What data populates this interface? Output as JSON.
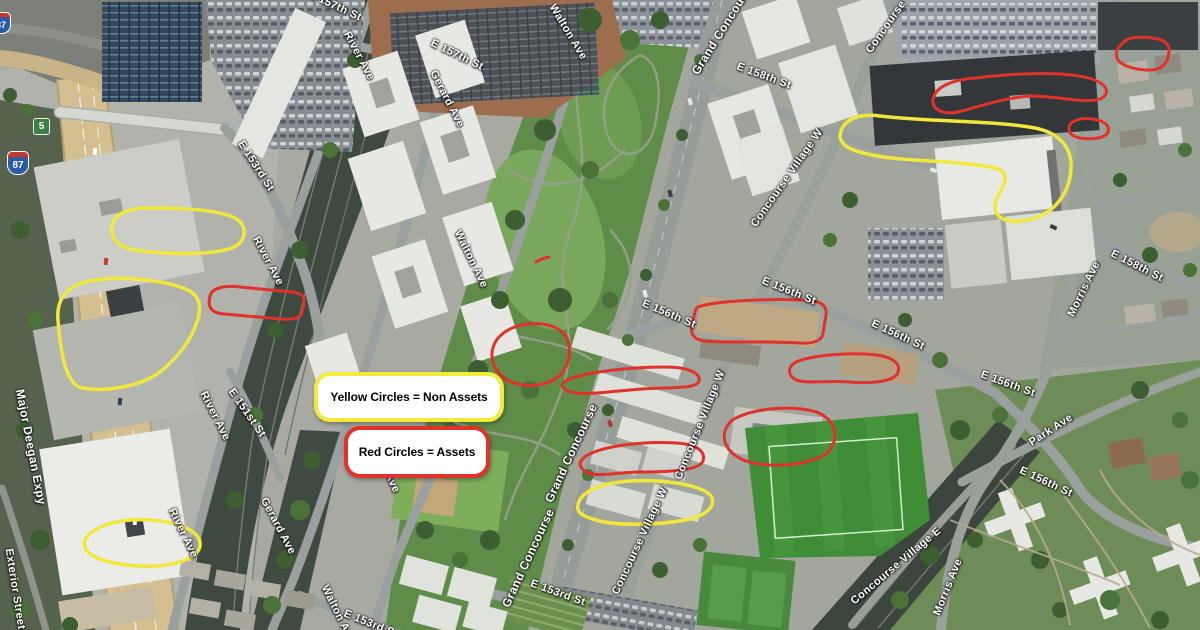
{
  "legend": {
    "non_assets": {
      "text": "Yellow Circles = Non Assets",
      "border_color": "#f2eb3a"
    },
    "assets": {
      "text": "Red Circles = Assets",
      "border_color": "#e0312b"
    }
  },
  "shields": {
    "interstate_87": "87",
    "route_5": "5"
  },
  "road_labels": [
    {
      "text": "E 157th St"
    },
    {
      "text": "River Ave"
    },
    {
      "text": "E 157th St"
    },
    {
      "text": "Gerard Ave"
    },
    {
      "text": "Walton Ave"
    },
    {
      "text": "Grand Concourse"
    },
    {
      "text": "E 158th St"
    },
    {
      "text": "Concourse Village W"
    },
    {
      "text": "Concourse Village W"
    },
    {
      "text": "E 156th St"
    },
    {
      "text": "E 156th St"
    },
    {
      "text": "E 156th St"
    },
    {
      "text": "E 158th St"
    },
    {
      "text": "Morris Ave"
    },
    {
      "text": "E 156th St"
    },
    {
      "text": "Park Ave"
    },
    {
      "text": "E 156th St"
    },
    {
      "text": "Concourse Village W"
    },
    {
      "text": "Grand Concourse"
    },
    {
      "text": "Grand Concourse"
    },
    {
      "text": "Concourse Village W"
    },
    {
      "text": "E 153rd St"
    },
    {
      "text": "Concourse Village E"
    },
    {
      "text": "Morris Ave"
    },
    {
      "text": "E 153rd St"
    },
    {
      "text": "River Ave"
    },
    {
      "text": "E 151st St"
    },
    {
      "text": "River Ave"
    },
    {
      "text": "River Ave"
    },
    {
      "text": "Gerard Ave"
    },
    {
      "text": "Walton Ave"
    },
    {
      "text": "Walton Ave"
    },
    {
      "text": "Walton Ave"
    },
    {
      "text": "Major Deegan Expy"
    },
    {
      "text": "Exterior Street"
    },
    {
      "text": "E 153rd St"
    }
  ],
  "annotations": {
    "non_asset_color": "#f0e93c",
    "asset_color": "#e0312b",
    "non_asset_shapes": [
      {
        "path": "M840,135 C842,120 858,113 880,116 C930,122 990,120 1035,128 C1060,133 1072,148 1071,168 C1070,190 1058,210 1035,218 C1012,226 986,220 998,196 C1006,182 1010,172 995,168 C960,160 905,162 872,155 C852,151 840,146 840,135 Z"
      },
      {
        "path": "M112,226 C114,214 128,208 150,208 C185,208 225,210 238,220 C248,228 246,242 232,248 C210,256 160,254 135,250 C118,247 110,238 112,226 Z"
      },
      {
        "path": "M58,320 C56,298 68,284 95,280 C125,276 165,280 188,290 C200,296 202,308 197,322 C191,340 178,358 160,372 C140,387 105,392 82,388 C64,384 60,345 58,320 Z"
      },
      {
        "path": "M85,540 C92,526 120,518 150,520 C180,522 202,532 200,546 C198,560 168,568 138,566 C108,564 80,556 85,540 Z"
      },
      {
        "path": "M578,505 C580,492 600,483 630,481 C665,479 702,485 711,496 C717,506 706,516 685,520 C660,525 620,526 600,521 C585,517 576,514 578,505 Z"
      }
    ],
    "asset_shapes": [
      {
        "path": "M1122,44 C1126,37 1140,36 1152,38 C1164,39 1170,44 1169,52 C1168,62 1163,70 1150,70 C1136,70 1120,66 1117,58 C1115,51 1118,47 1122,44 Z"
      },
      {
        "path": "M933,100 C934,88 950,80 975,78 C1010,74 1062,70 1092,79 C1106,84 1111,92 1102,98 C1090,105 1058,96 1032,96 C1006,97 982,106 958,112 C944,115 932,110 933,100 Z"
      },
      {
        "path": "M1069,128 C1069,121 1081,117 1093,119 C1105,121 1110,126 1108,132 C1106,138 1092,140 1080,138 C1071,136 1069,133 1069,128 Z"
      },
      {
        "path": "M210,296 C212,288 224,285 240,287 L292,292 C302,293 305,297 304,304 L302,312 C301,318 293,320 281,319 L224,314 C212,313 207,308 210,296 Z"
      },
      {
        "path": "M500,336 C514,322 545,319 561,331 C573,341 571,361 562,373 C551,386 527,389 509,381 C491,372 486,350 500,336 Z"
      },
      {
        "path": "M567,380 C585,372 630,367 665,367 C688,367 701,373 699,381 C697,389 672,387 642,389 C612,391 585,396 571,392 C561,389 560,384 567,380 Z"
      },
      {
        "path": "M701,306 C722,300 785,298 812,301 C823,302 827,307 826,315 L823,333 C822,341 813,344 798,343 C770,341 722,343 705,341 C694,340 690,334 692,325 L695,312 C696,308 697,307 701,306 Z"
      },
      {
        "path": "M796,362 C812,355 852,352 876,355 C893,357 901,364 898,372 C896,381 874,384 849,382 C824,380 801,385 793,378 C787,372 789,366 796,362 Z"
      },
      {
        "path": "M731,421 C751,407 800,404 821,414 C837,423 839,441 827,453 C812,465 770,469 746,461 C726,454 717,436 731,421 Z"
      },
      {
        "path": "M586,456 C602,446 642,441 676,443 C696,444 706,451 703,461 C700,470 671,472 641,472 C616,472 597,478 586,472 C578,466 578,462 586,456 Z"
      },
      {
        "path": "M536,262 C540,259 545,258 549,257"
      }
    ]
  }
}
